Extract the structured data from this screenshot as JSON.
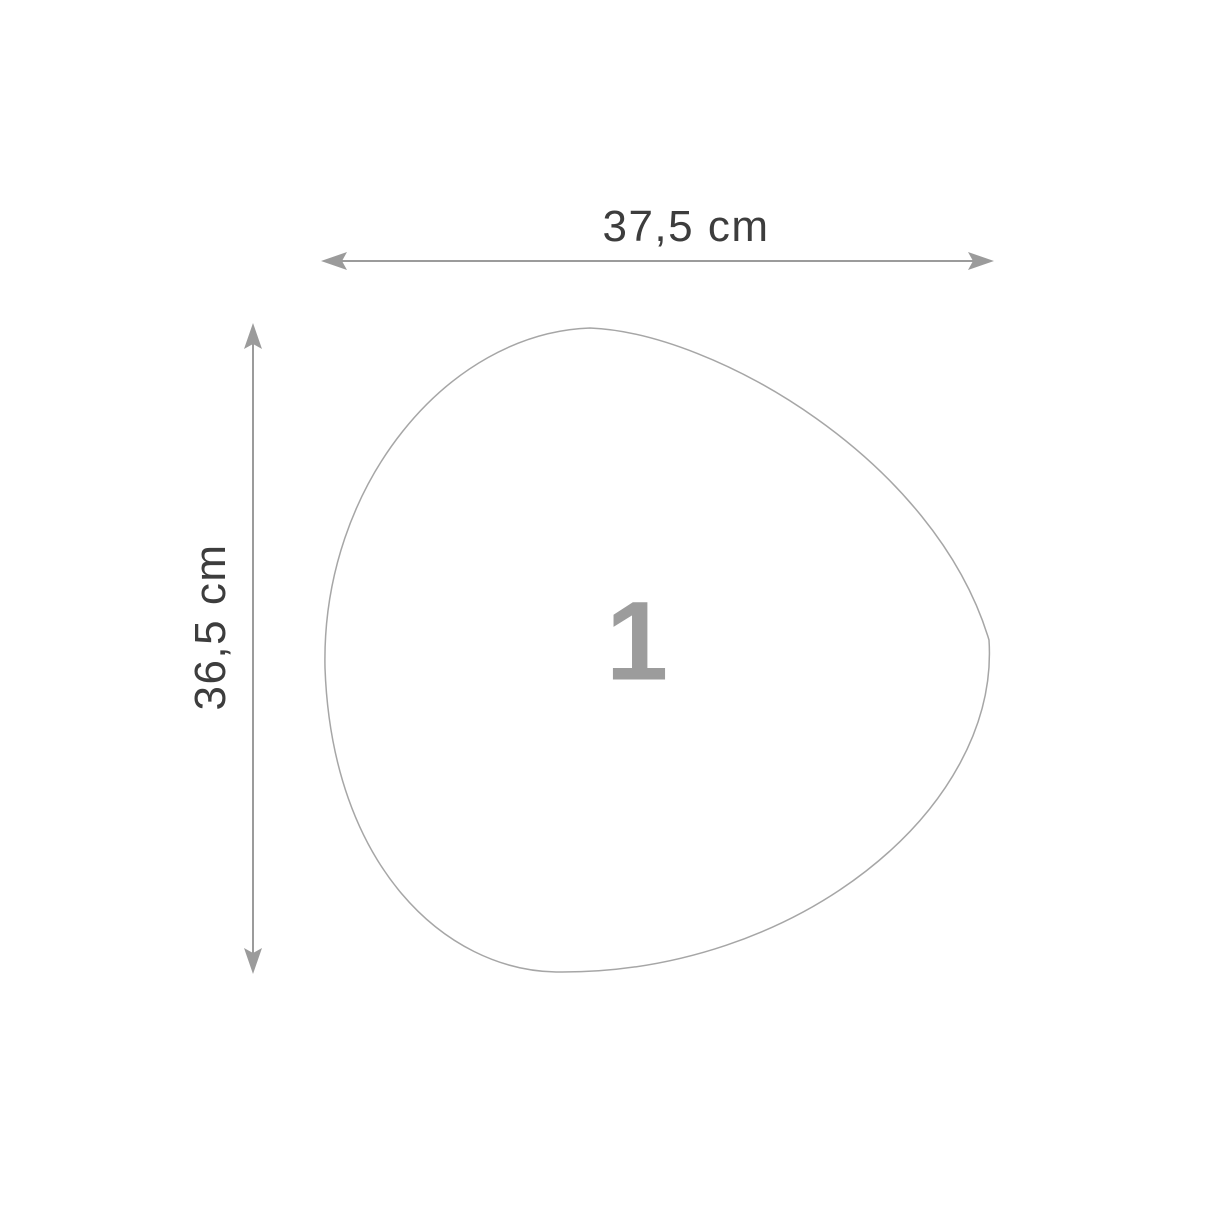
{
  "diagram": {
    "title": "shape-dimension-diagram",
    "shape": {
      "number": "1",
      "type": "organic-pebble-outline"
    },
    "dimensions": {
      "width_label": "37,5 cm",
      "height_label": "36,5 cm"
    },
    "colors": {
      "background": "#ffffff",
      "dimension_line": "#9b9b9b",
      "shape_outline": "#a6a6a6",
      "label_text": "#3d3d3d",
      "number_text": "#9c9c9c"
    }
  }
}
